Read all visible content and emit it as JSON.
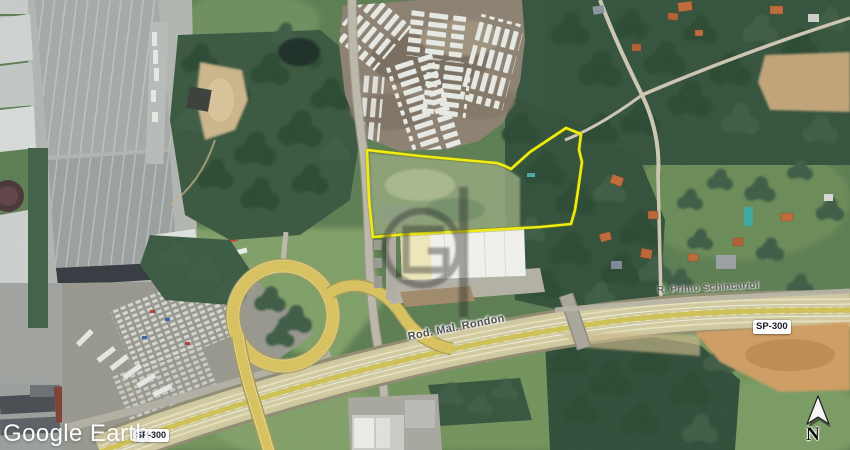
{
  "map": {
    "labels": {
      "road_main": "Rod. Mal. Rondon",
      "road_secondary": "R. Primo Schincariol",
      "route_badge_right": "SP-300",
      "route_badge_left": "SP-300"
    },
    "watermark_brand": "Google Earth",
    "compass": {
      "north_label": "N"
    },
    "colors": {
      "property_outline": "#f2ef0a",
      "highway_surface": "#d2cba0",
      "route_badge_bg": "#ffffff",
      "route_badge_text": "#1c1c28"
    }
  }
}
